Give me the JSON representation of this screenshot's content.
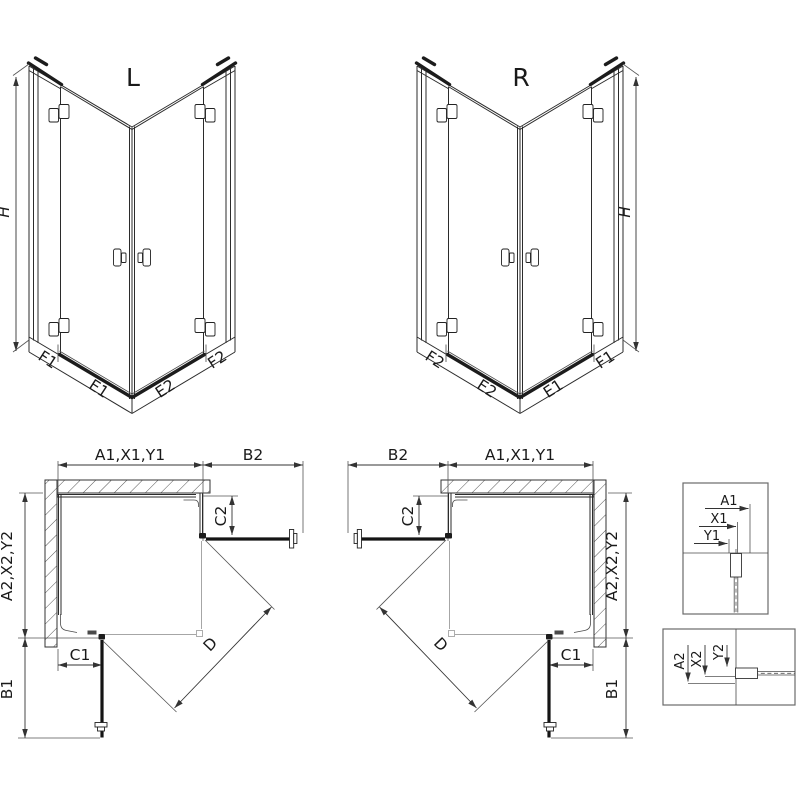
{
  "views": {
    "front_left": {
      "variant": "L",
      "height": "H",
      "f1": "F1",
      "e1": "E1",
      "e2": "E2",
      "f2": "F2"
    },
    "front_right": {
      "variant": "R",
      "height": "H",
      "f1": "F1",
      "e1": "E1",
      "e2": "E2",
      "f2": "F2"
    },
    "plan_left": {
      "width_top": "A1,X1,Y1",
      "door_ext": "B2",
      "c2": "C2",
      "depth": "A2,X2,Y2",
      "c1": "C1",
      "b1": "B1",
      "diagonal": "D"
    },
    "plan_right": {
      "width_top": "A1,X1,Y1",
      "door_ext": "B2",
      "c2": "C2",
      "depth": "A2,X2,Y2",
      "c1": "C1",
      "b1": "B1",
      "diagonal": "D"
    },
    "detail_top": {
      "a1": "A1",
      "x1": "X1",
      "y1": "Y1"
    },
    "detail_bottom": {
      "a2": "A2",
      "x2": "X2",
      "y2": "Y2"
    }
  },
  "colors": {
    "line": "#2b2b2b",
    "light_line": "#a6a6a6",
    "background": "#ffffff"
  }
}
